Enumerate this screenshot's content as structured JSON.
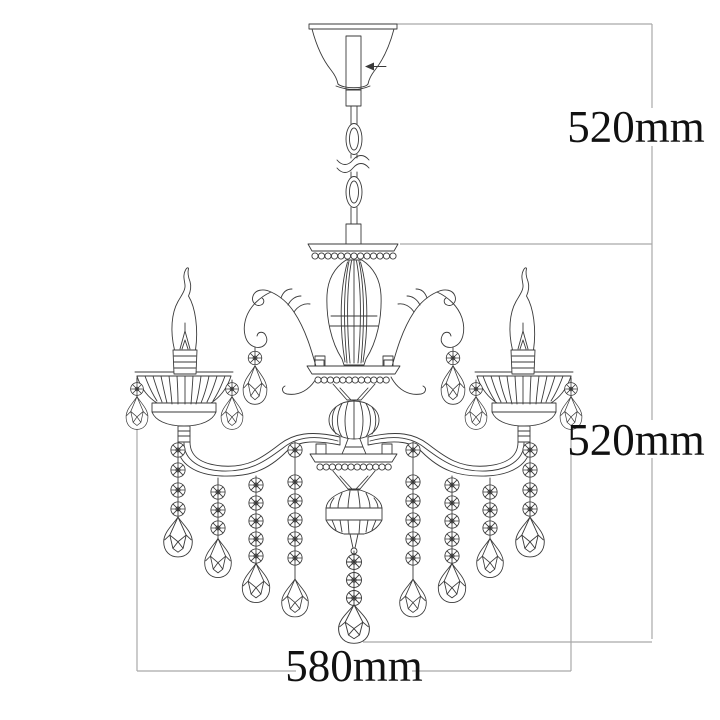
{
  "diagram": {
    "subject": "crystal-chandelier-line-drawing",
    "dimensions": {
      "hanging_height": "520mm",
      "fixture_height": "520mm",
      "width": "580mm"
    },
    "colors": {
      "drawing_line": "#3a3a3a",
      "dimension_line": "#a9a9a9",
      "label_text": "#111111",
      "background": "#ffffff"
    }
  }
}
